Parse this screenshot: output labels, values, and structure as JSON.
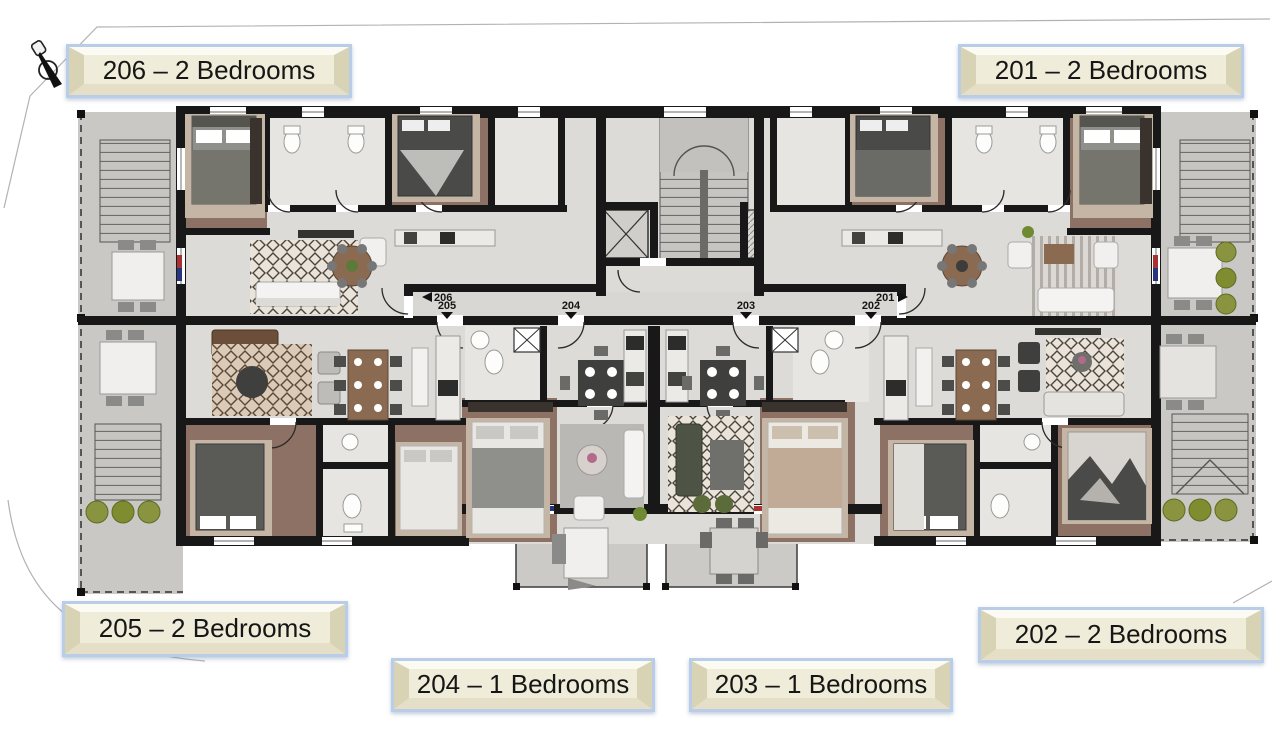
{
  "icons": {
    "drafting_pen": "drafting-pen-icon",
    "elevator": "elevator-icon",
    "stairs": "stairs-icon"
  },
  "plaques": {
    "u206": {
      "label": "206 – 2 Bedrooms"
    },
    "u201": {
      "label": "201 – 2 Bedrooms"
    },
    "u205": {
      "label": "205 – 2 Bedrooms"
    },
    "u202": {
      "label": "202 – 2 Bedrooms"
    },
    "u204": {
      "label": "204 – 1 Bedrooms"
    },
    "u203": {
      "label": "203 – 1 Bedrooms"
    }
  },
  "corridor_markers": {
    "u206": "206",
    "u205": "205",
    "u204": "204",
    "u203": "203",
    "u202": "202",
    "u201": "201"
  },
  "colors": {
    "wall": "#181818",
    "floor": "#dcdbd8",
    "bedroom_floor": "#8d7164",
    "bath_floor": "#e6e5e2",
    "terrace": "#c9c8c5",
    "plaque_face": "#efecd9",
    "plaque_border": "#b9cde9",
    "bush_green": "#8a9440",
    "threshold_red": "#a83232",
    "threshold_blue": "#27357e"
  }
}
